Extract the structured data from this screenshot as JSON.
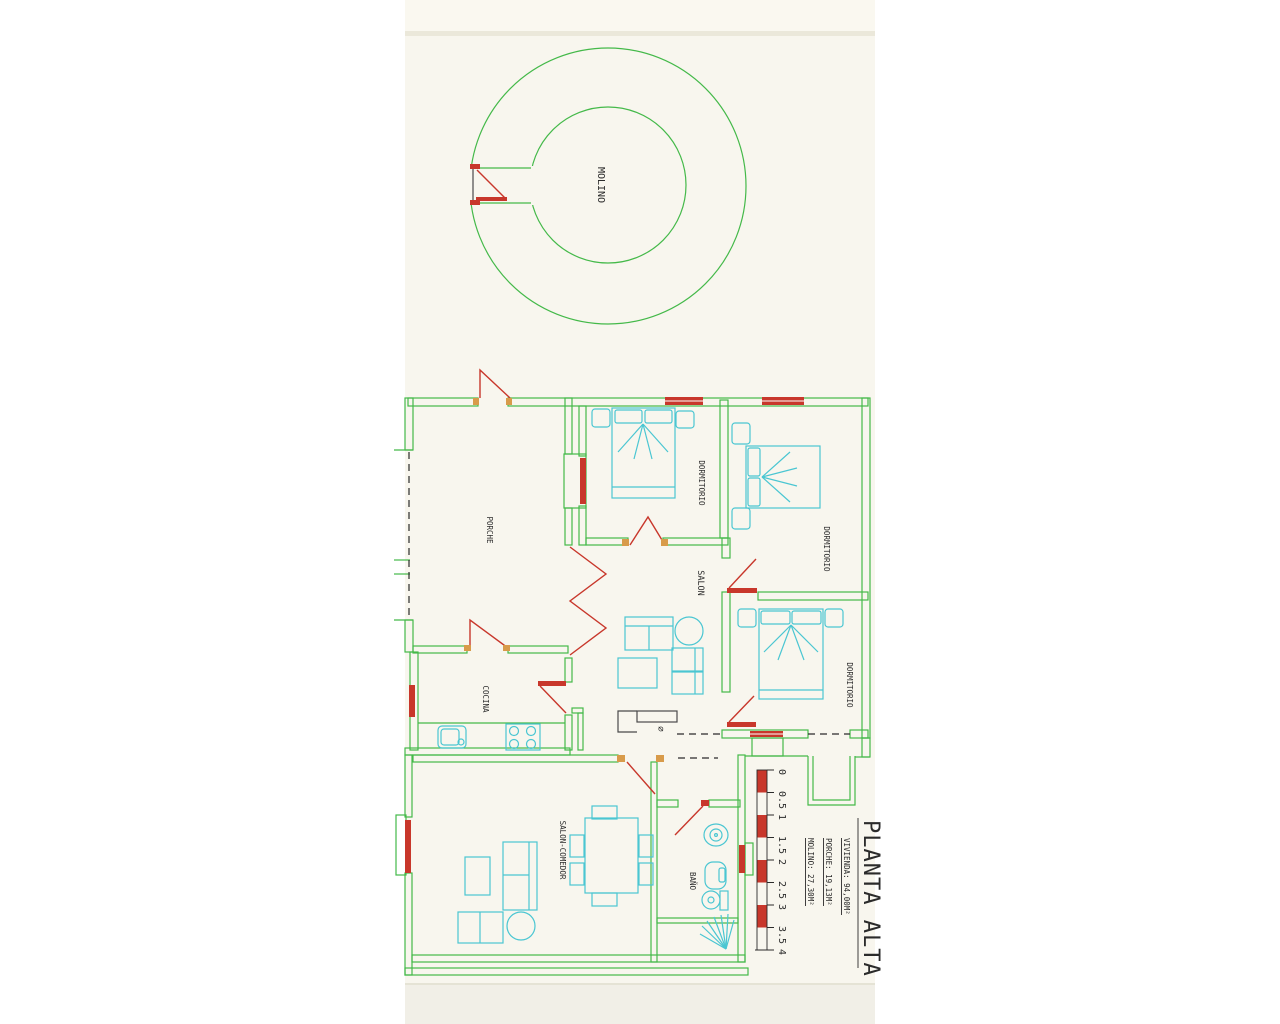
{
  "drawing": {
    "colors": {
      "wall_green": "#44b949",
      "accent_red": "#c8372b",
      "furniture_cyan": "#4ac6d2",
      "text_black": "#2b2b2b",
      "sheet_cream": "#f8f6ee"
    },
    "rooms": {
      "molino": "MOLINO",
      "porche": "PORCHE",
      "dormitorio_1": "DORMITORIO",
      "dormitorio_2": "DORMITORIO",
      "dormitorio_3": "DORMITORIO",
      "salon": "SALON",
      "cocina": "COCINA",
      "salon_comedor": "SALON-COMEDOR",
      "bano": "BAÑO"
    },
    "chimney_symbol": "⌀",
    "scale_bar": {
      "ticks": [
        "0",
        "0.5",
        "1",
        "1.5",
        "2",
        "2.5",
        "3",
        "3.5",
        "4"
      ]
    },
    "title_block": {
      "title": "PLANTA ALTA",
      "areas": [
        {
          "name": "vivienda",
          "label": "VIVIENDA: 94,00M²"
        },
        {
          "name": "porche",
          "label": "PORCHE: 19,13M²"
        },
        {
          "name": "molino",
          "label": "MOLINO: 27,30M²"
        }
      ]
    }
  }
}
